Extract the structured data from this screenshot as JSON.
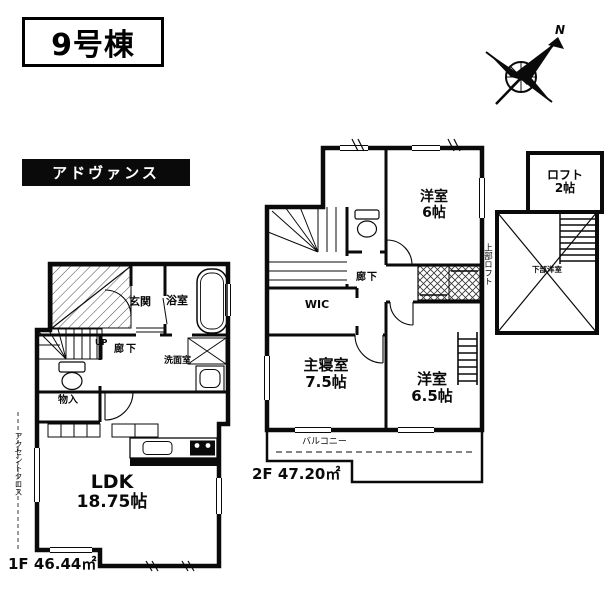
{
  "meta": {
    "bg_color": "#ffffff",
    "ink_color": "#0a0a0a"
  },
  "header": {
    "building_title": "9号棟",
    "brand_label": "アドヴァンス"
  },
  "compass": {
    "north_label": "N"
  },
  "floor1": {
    "area_label": "1F 46.44㎡",
    "side_note": "アクセントクロス",
    "rooms": {
      "ldk": {
        "name": "LDK",
        "size": "18.75帖"
      },
      "entrance": "玄関",
      "bathroom": "浴室",
      "hallway": "廊下",
      "stairs_up": "UP",
      "washroom": "洗面室",
      "storage": "物入"
    }
  },
  "floor2": {
    "area_label": "2F 47.20㎡",
    "side_note": "上部ロフト",
    "rooms": {
      "western_room_6": {
        "name": "洋室",
        "size": "6帖"
      },
      "master_bedroom": {
        "name": "主寝室",
        "size": "7.5帖"
      },
      "western_room_65": {
        "name": "洋室",
        "size": "6.5帖"
      },
      "wic": "WIC",
      "hallway": "廊下",
      "balcony": "バルコニー"
    }
  },
  "loft": {
    "name": "ロフト",
    "size": "2帖",
    "note": "下部洋室"
  }
}
